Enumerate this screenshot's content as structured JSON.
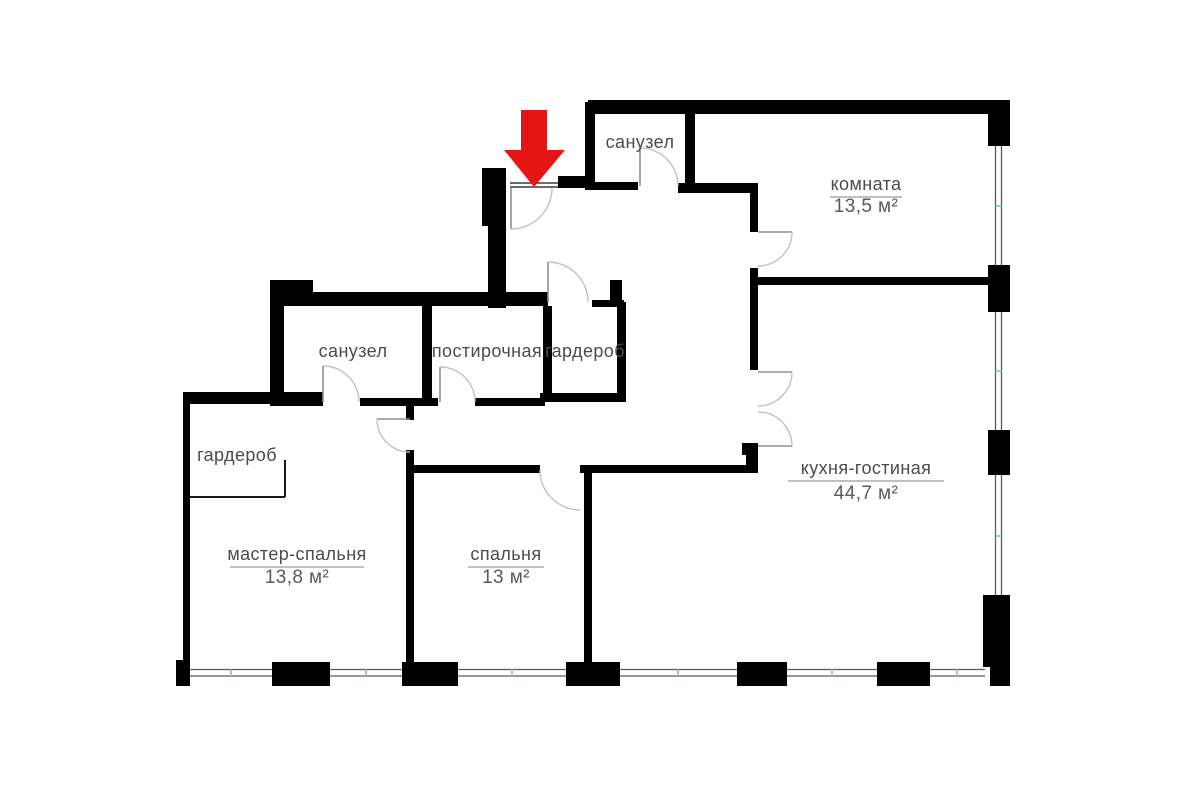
{
  "plan": {
    "type": "apartment-floor-plan",
    "background": "#ffffff",
    "wall_color": "#000000",
    "text_color": "#4b4b4b",
    "entrance_arrow_color": "#e51515",
    "window_tick_color": "#9ec7de"
  },
  "rooms": [
    {
      "id": "sanuzel-top",
      "name": "санузел"
    },
    {
      "id": "komnata",
      "name": "комната",
      "area": "13,5 м²"
    },
    {
      "id": "sanuzel-mid",
      "name": "санузел"
    },
    {
      "id": "postirochnaya",
      "name": "постирочная"
    },
    {
      "id": "garderob-mid",
      "name": "гардероб"
    },
    {
      "id": "garderob-left",
      "name": "гардероб"
    },
    {
      "id": "master",
      "name": "мастер-спальня",
      "area": "13,8 м²"
    },
    {
      "id": "spalnya",
      "name": "спальня",
      "area": "13 м²"
    },
    {
      "id": "kitchen",
      "name": "кухня-гостиная",
      "area": "44,7 м²"
    }
  ]
}
